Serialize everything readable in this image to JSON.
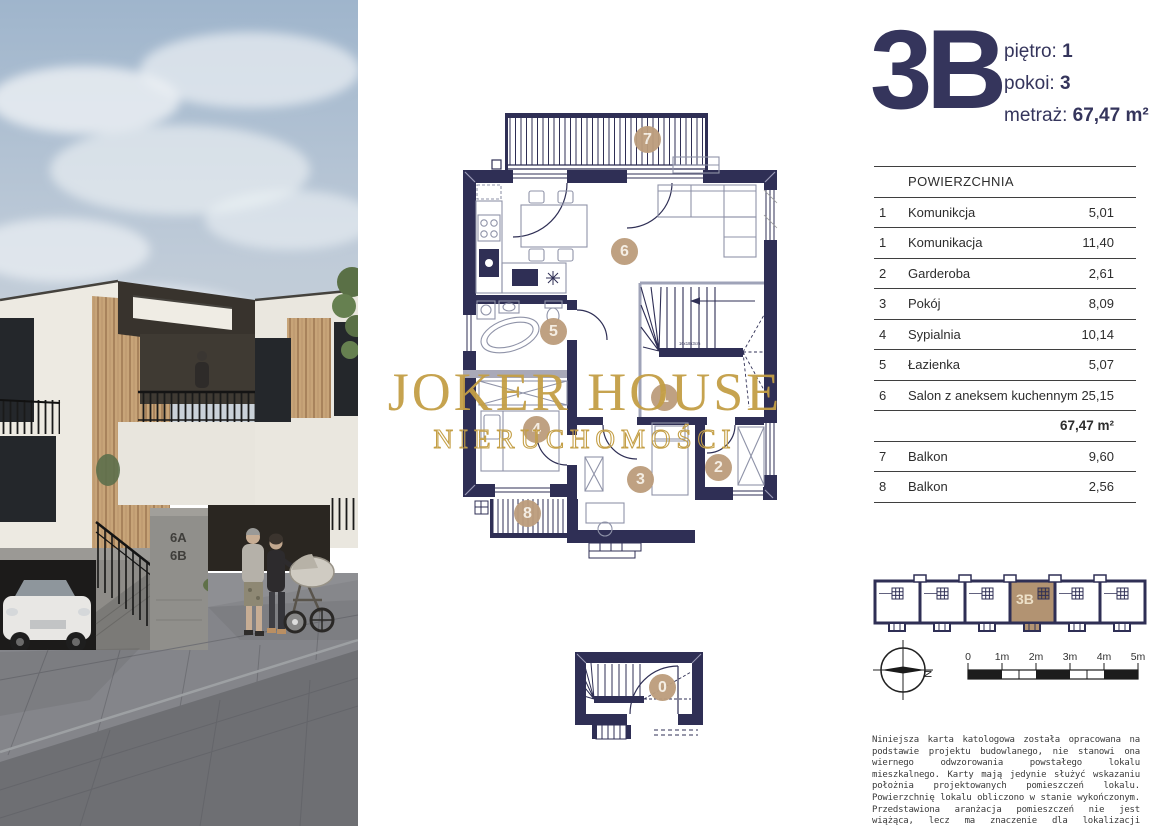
{
  "unit": {
    "code": "3B",
    "floor_label": "piętro:",
    "floor_value": "1",
    "rooms_label": "pokoi:",
    "rooms_value": "3",
    "area_label": "metraż:",
    "area_value": "67,47 m²"
  },
  "watermark": {
    "line1": "JOKER HOUSE",
    "line2": "NIERUCHOMOŚCI"
  },
  "table": {
    "header": "POWIERZCHNIA",
    "rows": [
      {
        "no": "1",
        "name": "Komunikcja",
        "area": "5,01"
      },
      {
        "no": "1",
        "name": "Komunikacja",
        "area": "11,40"
      },
      {
        "no": "2",
        "name": "Garderoba",
        "area": "2,61"
      },
      {
        "no": "3",
        "name": "Pokój",
        "area": "8,09"
      },
      {
        "no": "4",
        "name": "Sypialnia",
        "area": "10,14"
      },
      {
        "no": "5",
        "name": "Łazienka",
        "area": "5,07"
      },
      {
        "no": "6",
        "name": "Salon z aneksem kuchennym",
        "area": "25,15"
      }
    ],
    "total": "67,47 m²",
    "extra_rows": [
      {
        "no": "7",
        "name": "Balkon",
        "area": "9,60"
      },
      {
        "no": "8",
        "name": "Balkon",
        "area": "2,56"
      }
    ]
  },
  "floorplan": {
    "markers": [
      "7",
      "6",
      "5",
      "1",
      "4",
      "3",
      "2",
      "8"
    ],
    "ground_marker": "0",
    "stair_note": "16x18x3cm"
  },
  "photo": {
    "sign_line1": "6A",
    "sign_line2": "6B"
  },
  "mini_diagram": {
    "highlight_label": "3B"
  },
  "compass": {
    "north_label": "N"
  },
  "scale_bar": {
    "labels": [
      "0",
      "1m",
      "2m",
      "3m",
      "4m",
      "5m"
    ]
  },
  "disclaimer": "Niniejsza karta katologowa została opracowana na podstawie projektu budowlanego, nie stanowi ona wiernego odwzorowania powstałego lokalu mieszkalnego. Karty mają jedynie służyć wskazaniu położnia projektowanych pomieszczeń lokalu. Powierzchnię lokalu obliczono w stanie wykończonym. Przedstawiona aranżacja pomieszczeń nie jest wiążąca, lecz ma znaczenie dla lokalizacji przebiegu instalacji.",
  "colors": {
    "navy": "#2F2F55",
    "tan": "#BC9D7C",
    "gold": "#C49F46",
    "mini_highlight": "#B29372"
  }
}
